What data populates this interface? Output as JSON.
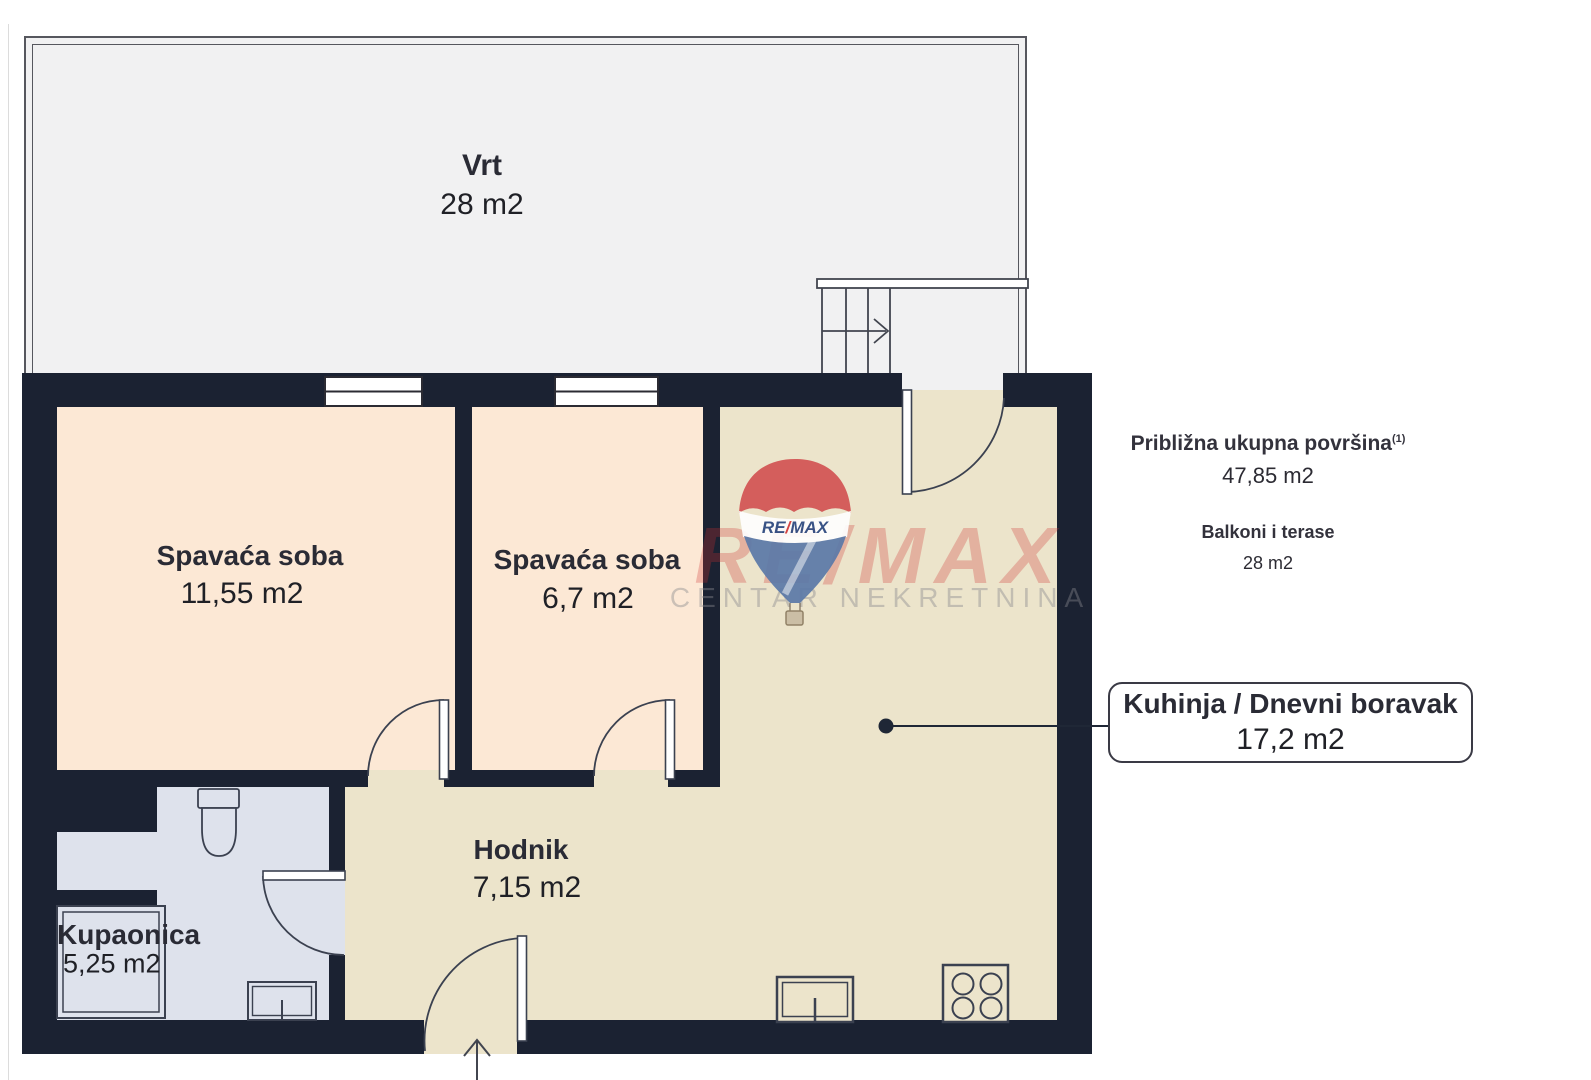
{
  "rooms": {
    "vrt": {
      "name": "Vrt",
      "area": "28 m2"
    },
    "bedroom1": {
      "name": "Spavaća soba",
      "area": "11,55 m2"
    },
    "bedroom2": {
      "name": "Spavaća soba",
      "area": "6,7 m2"
    },
    "hodnik": {
      "name": "Hodnik",
      "area": "7,15 m2"
    },
    "kupaonica": {
      "name": "Kupaonica",
      "area": "5,25 m2"
    },
    "kuhinja": {
      "name": "Kuhinja / Dnevni boravak",
      "area": "17,2 m2"
    }
  },
  "summary": {
    "total_label": "Približna ukupna površina",
    "total_footnote": "(1)",
    "total_value": "47,85 m2",
    "balcony_label": "Balkoni i terase",
    "balcony_value": "28 m2"
  },
  "watermark": {
    "brand": "RE/MAX",
    "subtitle": "CENTAR NEKRETNINA",
    "balloon": {
      "re": "RE",
      "slash": "/",
      "max": "MAX"
    }
  },
  "colors": {
    "wall": "#1b2232",
    "bedroom_floor": "#fce8d5",
    "living_floor": "#ece4cb",
    "bathroom_floor": "#dee2ec",
    "terrace_floor": "#f1f1f2",
    "brand_red": "#d15252",
    "brand_blue": "#5b79a8"
  }
}
